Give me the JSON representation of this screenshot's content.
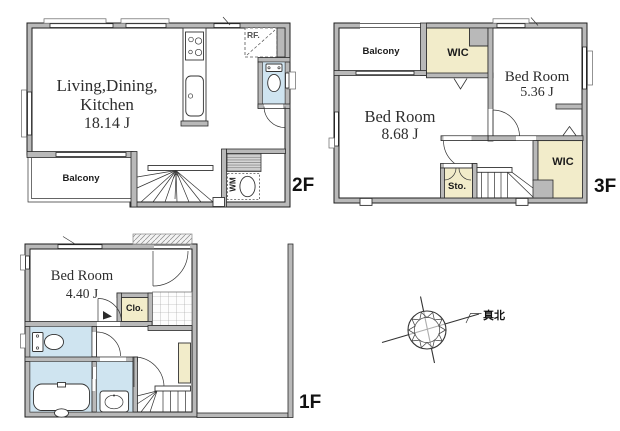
{
  "colors": {
    "wall_fill": "#b9b9b9",
    "outline": "#1e1e1e",
    "wet_area_fill": "#cfe4f0",
    "storage_fill": "#f2ecca",
    "text": "#2e2e2e"
  },
  "floor2": {
    "name": "2F",
    "ldk_line1": "Living,Dining,",
    "ldk_line2": "Kitchen",
    "ldk_area": "18.14 J",
    "balcony": "Balcony",
    "fridge": "RF.",
    "washing_machine": "WM"
  },
  "floor3": {
    "name": "3F",
    "balcony": "Balcony",
    "wic_top": "WIC",
    "wic_bottom": "WIC",
    "bedroom_right_name": "Bed Room",
    "bedroom_right_area": "5.36 J",
    "bedroom_left_name": "Bed Room",
    "bedroom_left_area": "8.68 J",
    "storage": "Sto."
  },
  "floor1": {
    "name": "1F",
    "bedroom_name": "Bed Room",
    "bedroom_area": "4.40 J",
    "closet": "Clo."
  },
  "compass": {
    "true_north": "真北"
  }
}
